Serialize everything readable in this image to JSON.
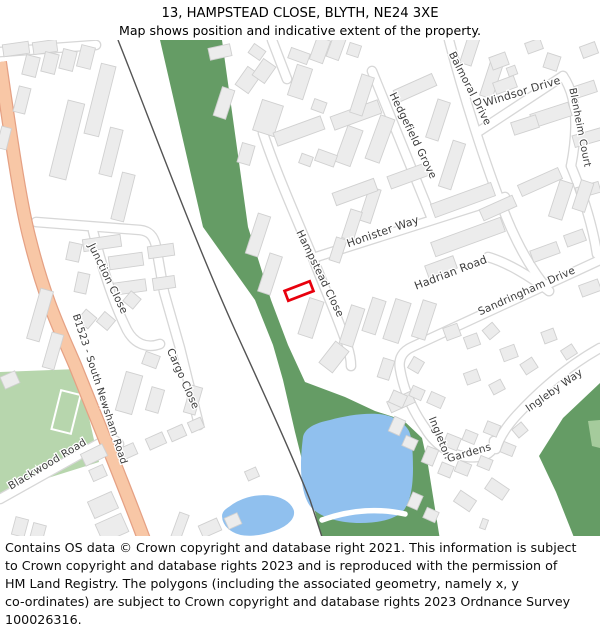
{
  "title": {
    "line1": "13, HAMPSTEAD CLOSE, BLYTH, NE24 3XE",
    "line2": "Map shows position and indicative extent of the property."
  },
  "map": {
    "streets": [
      "B1523 - South Newsham Road",
      "Junction Close",
      "Cargo Close",
      "Blackwood Road",
      "Hampstead Close",
      "Honister Way",
      "Hedgefield Grove",
      "Balmoral Drive",
      "Windsor Drive",
      "Blenheim Court",
      "Hadrian Road",
      "Sandringham Drive",
      "Ingleby Way",
      "Ingleton",
      "Gardens"
    ],
    "property_outline_color": "#e8000d"
  },
  "colors": {
    "plot_outline": "#e8000d",
    "greenspace": "#659c65",
    "field_green": "#b7d6ad",
    "pale_green": "#a5cb9c",
    "water": "#90c0ee",
    "b_road_fill": "#f8c7a6",
    "b_road_edge": "#e5a184",
    "railway": "#545454",
    "building_fill": "#ececec",
    "building_edge": "#d0d0d0",
    "road_casing": "#d7d7d7",
    "road_fill": "#ffffff",
    "label_text": "#3c3c3c"
  },
  "footer": {
    "lines": [
      "Contains OS data © Crown copyright and database right 2021. This information is subject",
      "to Crown copyright and database rights 2023 and is reproduced with the permission of",
      "HM Land Registry. The polygons (including the associated geometry, namely x, y",
      "co-ordinates) are subject to Crown copyright and database rights 2023 Ordnance Survey",
      "100026316."
    ]
  }
}
